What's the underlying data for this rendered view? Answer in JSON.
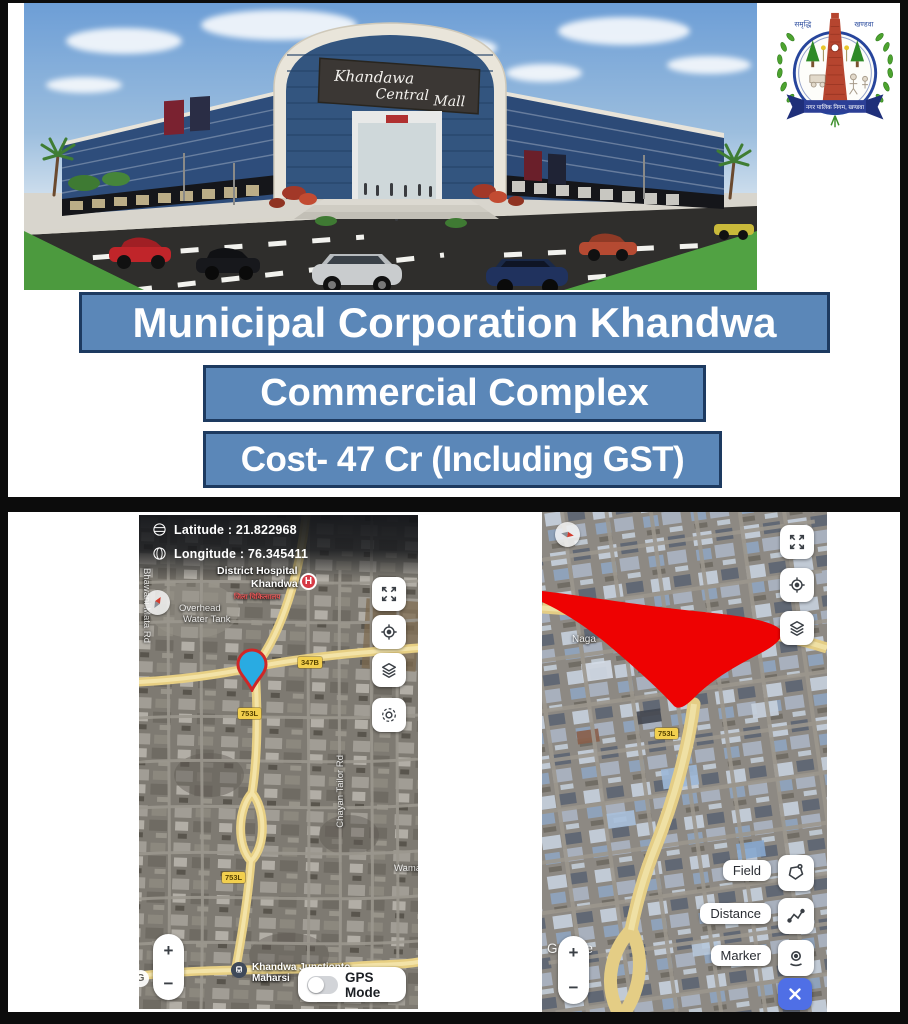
{
  "banners": {
    "line1": "Municipal Corporation Khandwa",
    "line2": "Commercial Complex",
    "line3": "Cost- 47 Cr (Including GST)"
  },
  "mall": {
    "sign_word1": "Khandawa",
    "sign_word2": "Central",
    "sign_word3": "Mall"
  },
  "logo": {
    "top_left": "समृद्धि",
    "top_right": "खण्डवा",
    "ribbon_text": "नगर पालिक निगम, खण्डवा"
  },
  "left_map": {
    "latitude": "Latitude : 21.822968",
    "longitude": "Longitude : 76.345411",
    "hospital_line1": "District Hospital",
    "hospital_line2": "Khandwa",
    "hospital_sub": "जिला चिकित्सालय",
    "hospital_marker": "H",
    "water_tank_line1": "Overhead",
    "water_tank_line2": "Water Tank",
    "road_vertical_left": "Bhawani Mata Rd",
    "road_vertical_right": "Chayan Tailor Rd",
    "badge_347": "347B",
    "badge_753": "753L",
    "wama": "Wama",
    "junction_line1": "Khandwa Junctionto",
    "junction_line2": "Maharsi",
    "gps_mode": "GPS Mode",
    "zoom_in": "+",
    "zoom_out": "−",
    "g_badge": "G"
  },
  "right_map": {
    "naga": "Naga",
    "badge_753": "753L",
    "field": "Field",
    "distance": "Distance",
    "marker": "Marker",
    "google": "Google",
    "zoom_in": "+",
    "zoom_out": "−"
  }
}
